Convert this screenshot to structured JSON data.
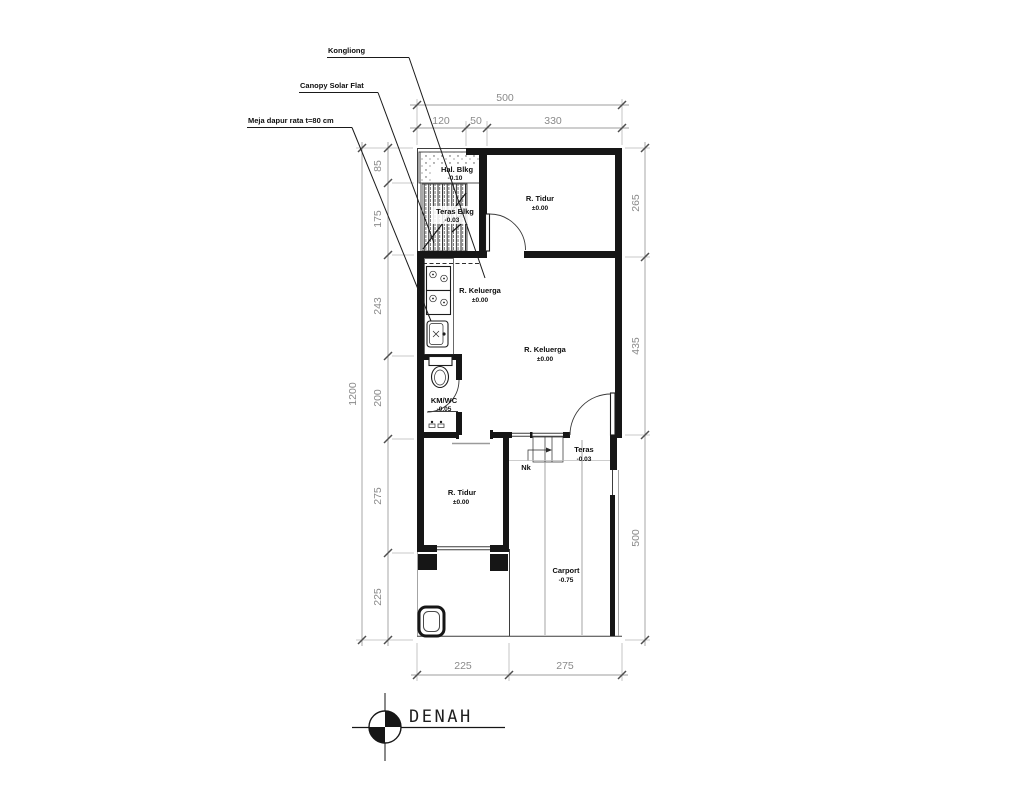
{
  "title": {
    "label": "DENAH"
  },
  "leaders": {
    "kongliong": "Kongliong",
    "canopy": "Canopy Solar Flat",
    "meja": "Meja dapur rata t=80 cm"
  },
  "rooms": {
    "hal_blkg": {
      "name": "Hal. Blkg",
      "level": "-0.10"
    },
    "teras_blkg": {
      "name": "Teras Blkg",
      "level": "-0.03"
    },
    "tidur_atas": {
      "name": "R. Tidur",
      "level": "±0.00"
    },
    "keluarga_a": {
      "name": "R. Keluerga",
      "level": "±0.00"
    },
    "keluarga_b": {
      "name": "R. Keluerga",
      "level": "±0.00"
    },
    "km_wc": {
      "name": "KM/WC",
      "level": "-0.05"
    },
    "teras_depan": {
      "name": "Teras",
      "level": "-0.03"
    },
    "nk": {
      "name": "Nk"
    },
    "tidur_bawah": {
      "name": "R. Tidur",
      "level": "±0.00"
    },
    "carport": {
      "name": "Carport",
      "level": "-0.75"
    }
  },
  "dimensions": {
    "top_total": "500",
    "top_segments": [
      "120",
      "50",
      "330"
    ],
    "left_total": "1200",
    "left_segments": [
      "85",
      "175",
      "243",
      "200",
      "275",
      "225"
    ],
    "right_segments": [
      "265",
      "435",
      "500"
    ],
    "bottom_segments": [
      "225",
      "275"
    ]
  },
  "colors": {
    "wall": "#161616",
    "dimension": "#9e9e9e",
    "text": "#0e0e0e",
    "background": "#ffffff"
  }
}
